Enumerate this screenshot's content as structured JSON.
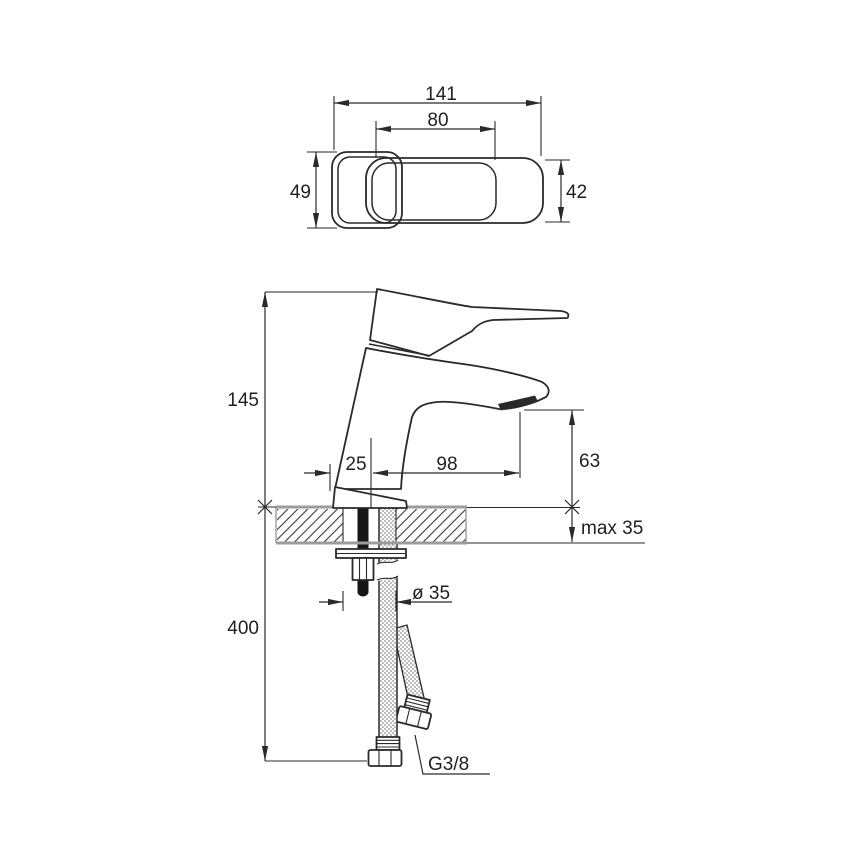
{
  "drawing": {
    "kind": "technical-dimension-drawing",
    "subject": "single-hole basin faucet with supply hoses",
    "units": "mm",
    "colors": {
      "line": "#2a2a2a",
      "deck_edge": "#9c9c9c",
      "hose_dot": "#8d8d8d",
      "stud_fill": "#161616",
      "background": "#ffffff"
    },
    "top_view": {
      "overall_length": "141",
      "lever_length": "80",
      "body_depth": "49",
      "lever_width": "42"
    },
    "side_view": {
      "body_height": "145",
      "hose_drop": "400",
      "axis_offset": "25",
      "spout_reach": "98",
      "spout_height": "63",
      "deck_thickness": "max 35",
      "hole_diameter": "ø 35",
      "connection_thread": "G3/8"
    }
  }
}
